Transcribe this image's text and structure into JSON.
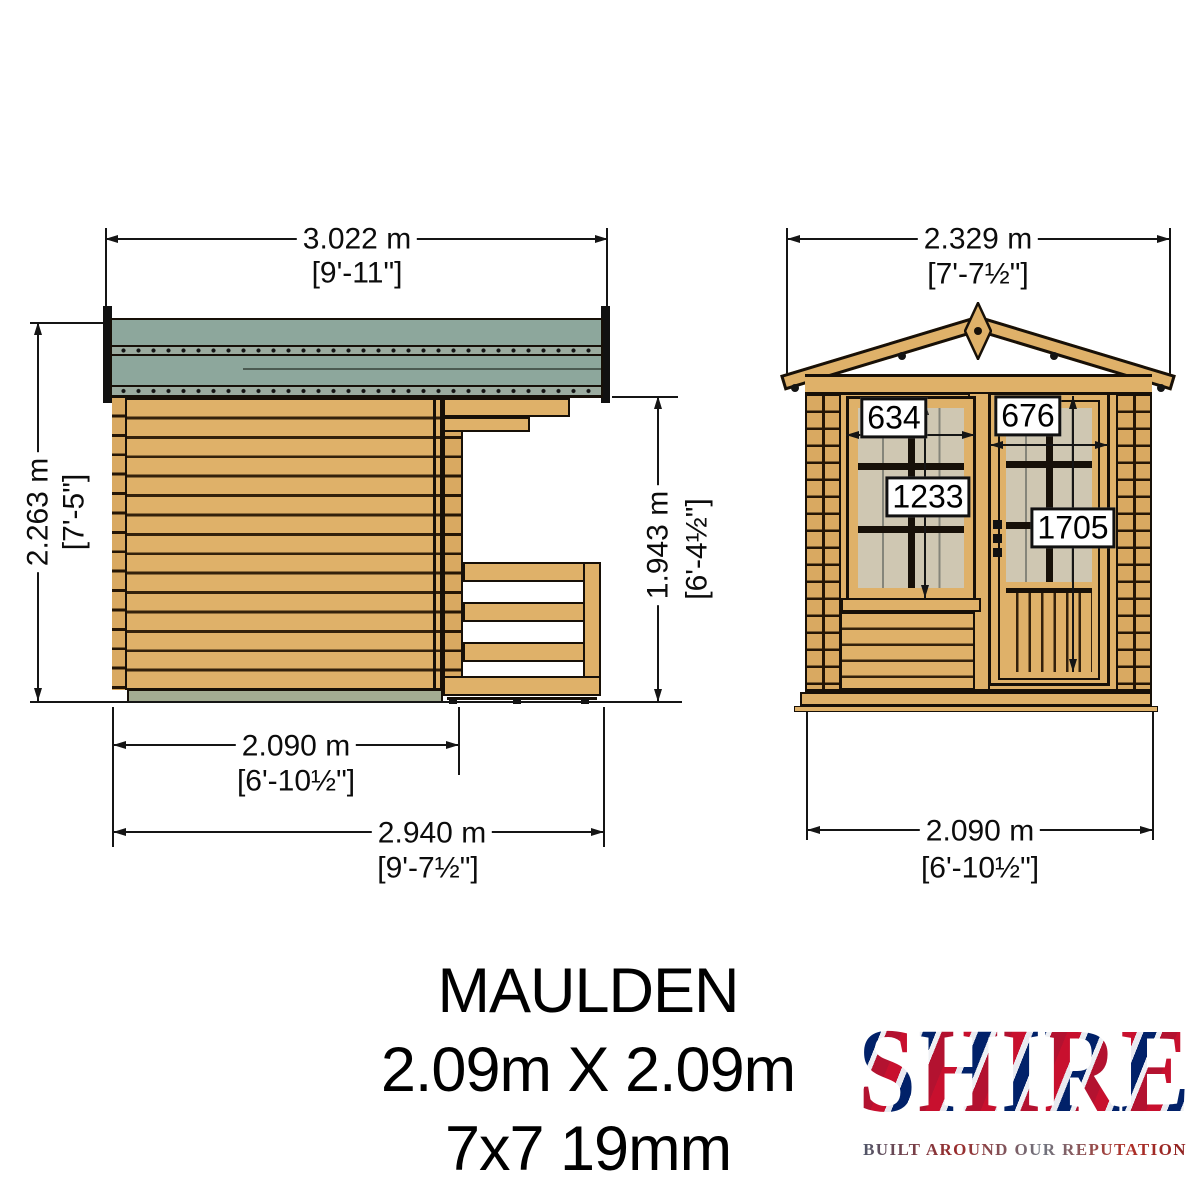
{
  "colors": {
    "roof_green": "#8da79c",
    "roof_strip": "#9bab9f",
    "wood": "#dfb169",
    "wood_shade": "#d9a961",
    "wood_line": "#33210c",
    "pane_beige": "#cfc7b2",
    "base_green": "#a3ac92",
    "outline": "#171008",
    "union_red": "#c8102e",
    "union_blue": "#012169"
  },
  "side_view": {
    "dim_width_top": {
      "metric": "3.022 m",
      "imperial": "[9'-11\"]"
    },
    "dim_height_left": {
      "metric": "2.263 m",
      "imperial": "[7'-5\"]"
    },
    "dim_height_right": {
      "metric": "1.943 m",
      "imperial": "[6'-4½\"]"
    },
    "dim_depth_shed": {
      "metric": "2.090 m",
      "imperial": "[6'-10½\"]"
    },
    "dim_depth_total": {
      "metric": "2.940 m",
      "imperial": "[9'-7½\"]"
    }
  },
  "front_view": {
    "dim_width_top": {
      "metric": "2.329 m",
      "imperial": "[7'-7½\"]"
    },
    "dim_width_bottom": {
      "metric": "2.090 m",
      "imperial": "[6'-10½\"]"
    },
    "window_width_mm": "634",
    "door_width_mm": "676",
    "window_height_mm": "1233",
    "door_height_mm": "1705"
  },
  "title_block": {
    "product_name": "MAULDEN",
    "size": "2.09m X 2.09m",
    "spec": "7x7 19mm"
  },
  "logo": {
    "brand": "SHIRE",
    "tagline": "BUILT AROUND OUR REPUTATION"
  }
}
